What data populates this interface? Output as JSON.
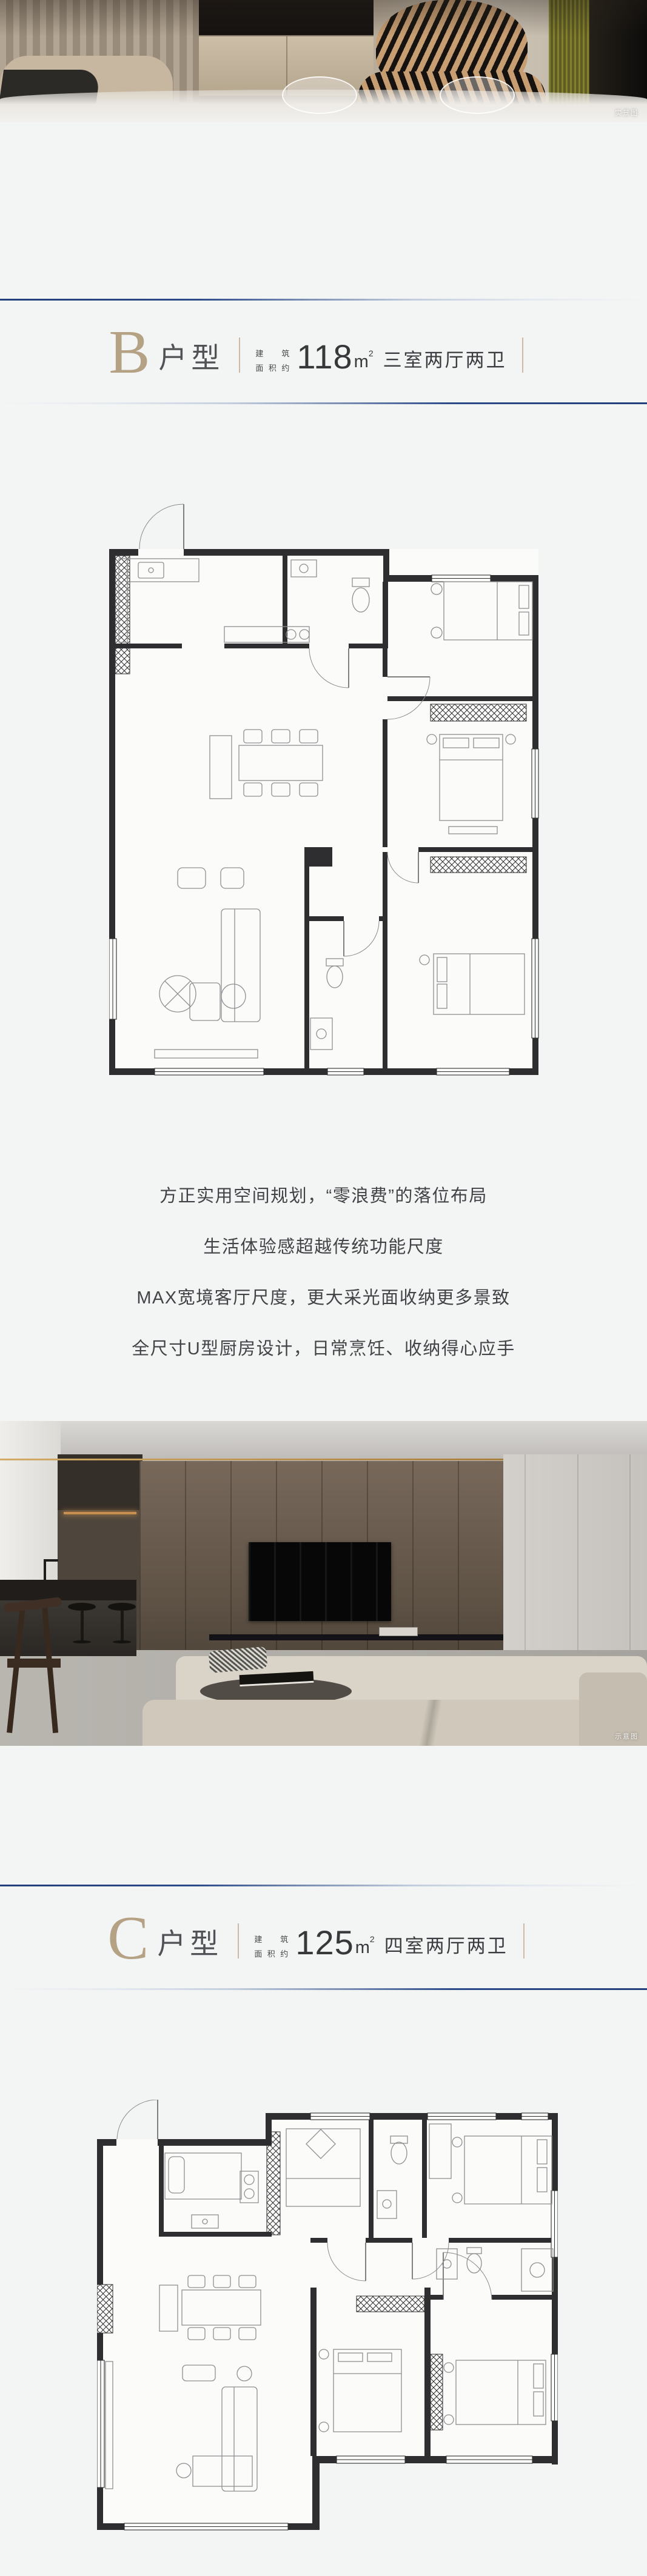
{
  "photos": {
    "top": {
      "caption": "实景图"
    },
    "middle": {
      "caption": "示意图"
    }
  },
  "unit_b": {
    "letter": "B",
    "suffix": "户型",
    "area_label_top": [
      "建",
      "筑"
    ],
    "area_label_bottom": [
      "面",
      "积",
      "约"
    ],
    "area_value": "118",
    "area_unit_base": "m",
    "area_unit_sup": "2",
    "layout": "三室两厅两卫"
  },
  "unit_c": {
    "letter": "C",
    "suffix": "户型",
    "area_label_top": [
      "建",
      "筑"
    ],
    "area_label_bottom": [
      "面",
      "积",
      "约"
    ],
    "area_value": "125",
    "area_unit_base": "m",
    "area_unit_sup": "2",
    "layout": "四室两厅两卫"
  },
  "features": [
    "方正实用空间规划，“零浪费”的落位布局",
    "生活体验感超越传统功能尺度",
    "MAX宽境客厅尺度，更大采光面收纳更多景致",
    "全尺寸U型厨房设计，日常烹饪、收纳得心应手"
  ],
  "colors": {
    "accent_tan": "#b5a183",
    "navy": "#24407a",
    "text_dark": "#424346"
  }
}
